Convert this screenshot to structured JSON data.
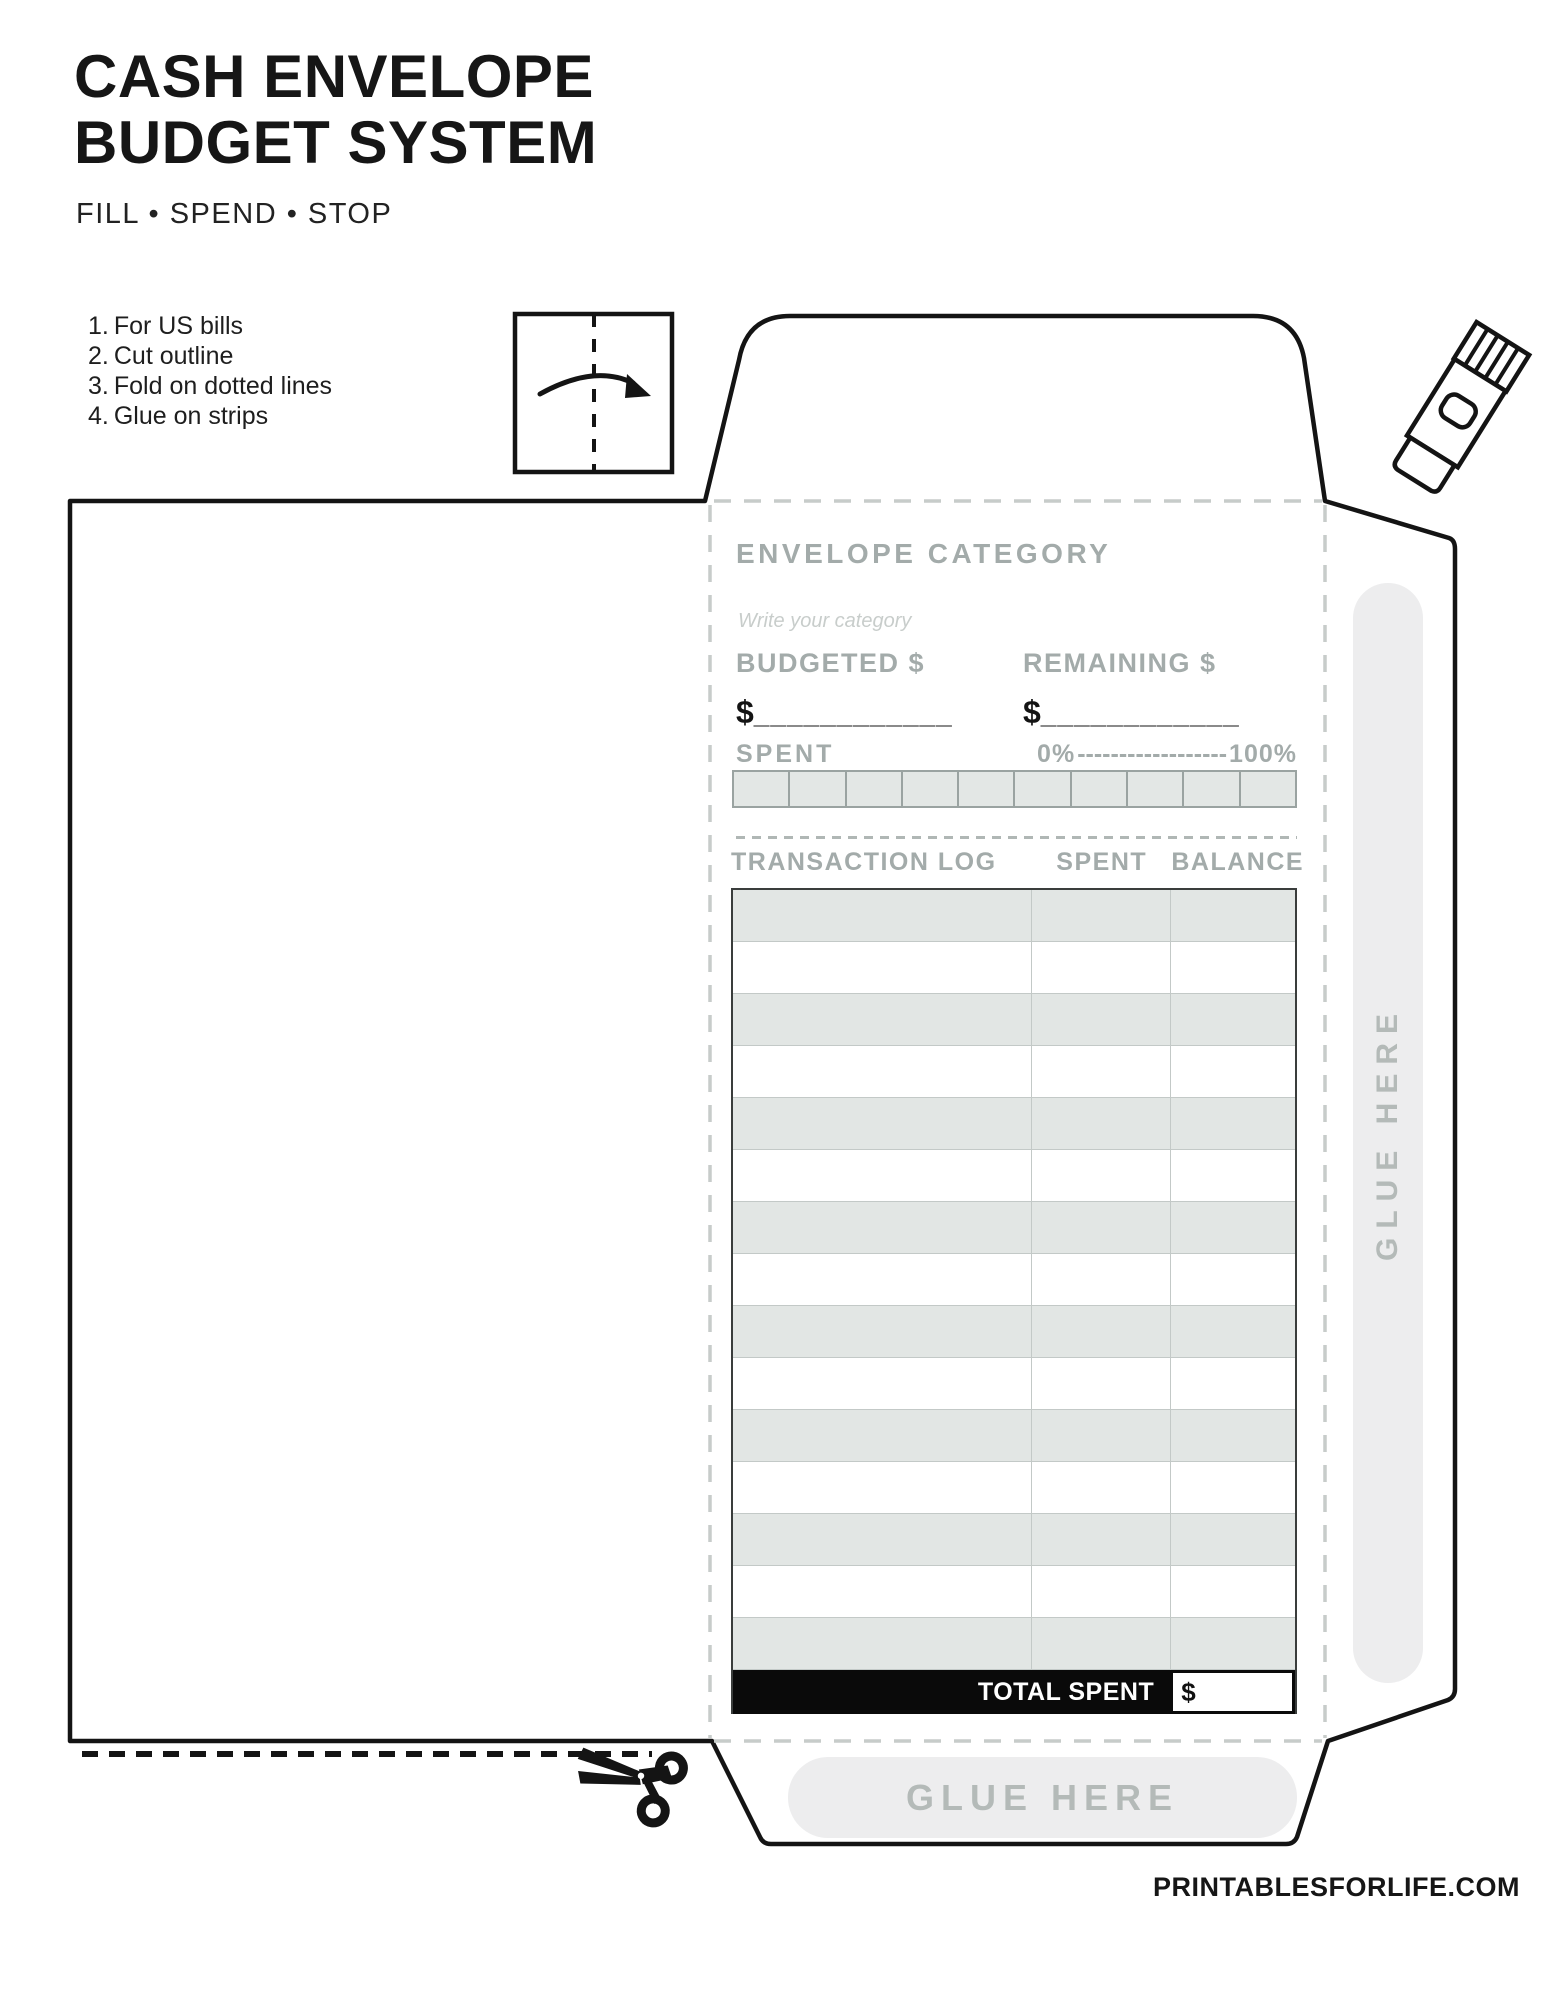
{
  "header": {
    "title_line1": "CASH ENVELOPE",
    "title_line2": "BUDGET SYSTEM",
    "tagline": "FILL • SPEND • STOP"
  },
  "instructions": {
    "items": [
      {
        "num": "1.",
        "text": "For US bills"
      },
      {
        "num": "2.",
        "text": "Cut outline"
      },
      {
        "num": "3.",
        "text": "Fold on dotted lines"
      },
      {
        "num": "4.",
        "text": "Glue on strips"
      }
    ]
  },
  "envelope": {
    "category": {
      "heading": "ENVELOPE CATEGORY",
      "placeholder": "Write your category"
    },
    "budget_fields": {
      "budgeted_label": "BUDGETED $",
      "remaining_label": "REMAINING $",
      "currency_symbol": "$",
      "blank_line": "____________"
    },
    "spent_meter": {
      "label": "SPENT",
      "scale_start": "0%",
      "scale_dashes": "------------------",
      "scale_end": "100%",
      "segment_count": 10
    },
    "transaction_table": {
      "headers": [
        "TRANSACTION LOG",
        "SPENT",
        "BALANCE"
      ],
      "row_count": 15,
      "total_label": "TOTAL SPENT",
      "total_currency_symbol": "$"
    },
    "glue_side_label": "GLUE HERE",
    "glue_bottom_label": "GLUE HERE"
  },
  "footer": {
    "website": "PRINTABLESFORLIFE.COM"
  },
  "icons": {
    "fold_diagram": "fold-arrow-icon",
    "glue_stick": "glue-stick-icon",
    "scissors": "scissors-icon"
  },
  "colors": {
    "ink_black": "#141414",
    "label_gray": "#a3abaa",
    "placeholder_gray": "#c8cdcb",
    "row_gray": "#e2e6e4",
    "pill_gray": "#ededee",
    "fold_dash_gray": "#c7ccca"
  }
}
